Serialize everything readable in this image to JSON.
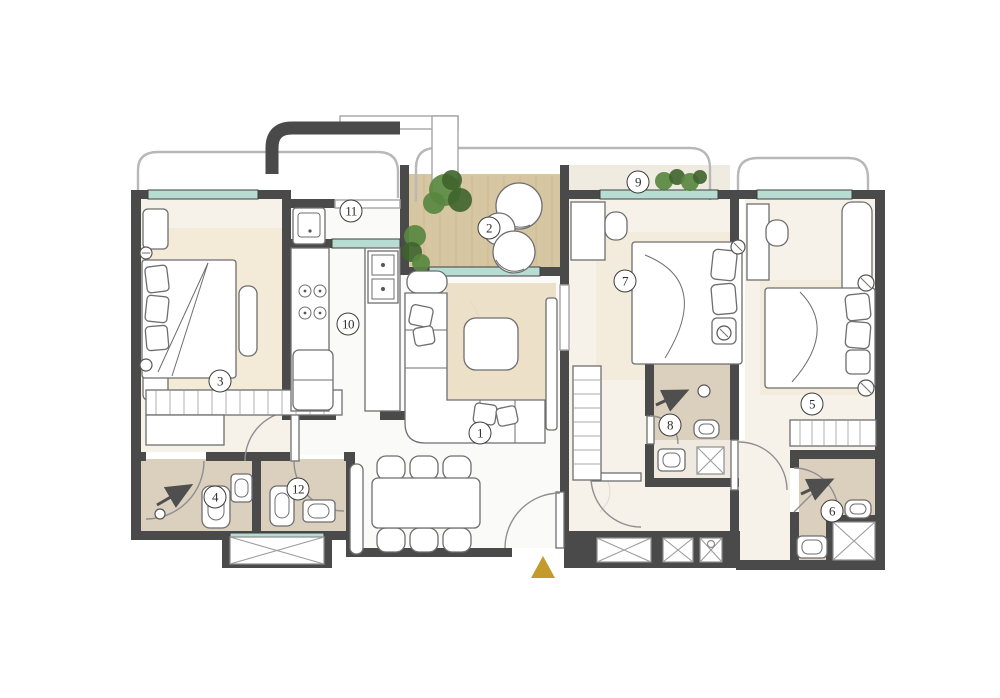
{
  "plan": {
    "room_markers": [
      {
        "label": "1",
        "x": 480,
        "y": 433
      },
      {
        "label": "2",
        "x": 489,
        "y": 228
      },
      {
        "label": "3",
        "x": 220,
        "y": 381
      },
      {
        "label": "4",
        "x": 215,
        "y": 497
      },
      {
        "label": "5",
        "x": 812,
        "y": 404
      },
      {
        "label": "6",
        "x": 832,
        "y": 511
      },
      {
        "label": "7",
        "x": 625,
        "y": 281
      },
      {
        "label": "8",
        "x": 670,
        "y": 425
      },
      {
        "label": "9",
        "x": 638,
        "y": 182
      },
      {
        "label": "10",
        "x": 348,
        "y": 324
      },
      {
        "label": "11",
        "x": 351,
        "y": 211
      },
      {
        "label": "12",
        "x": 298,
        "y": 489
      }
    ],
    "entrance": {
      "symbol": "entrance-triangle",
      "x": 543,
      "y": 556
    },
    "colors": {
      "wall": "#4a4a4a",
      "window_glass": "#b7dcd2",
      "room_floor": "#f6f2e9",
      "floor_white": "#fafaf8",
      "bathroom_floor": "#dbcfbd",
      "balcony_wood": "#d7c6a2",
      "rug_beige": "#e8dabb",
      "plant_green": "#58873f",
      "plant_green_dark": "#3e642c",
      "entrance_gold": "#c49a2c",
      "furniture_stroke": "#6e6e6e",
      "railing_gray": "#b8b8b8",
      "marker_border": "#3c3c3c"
    }
  }
}
